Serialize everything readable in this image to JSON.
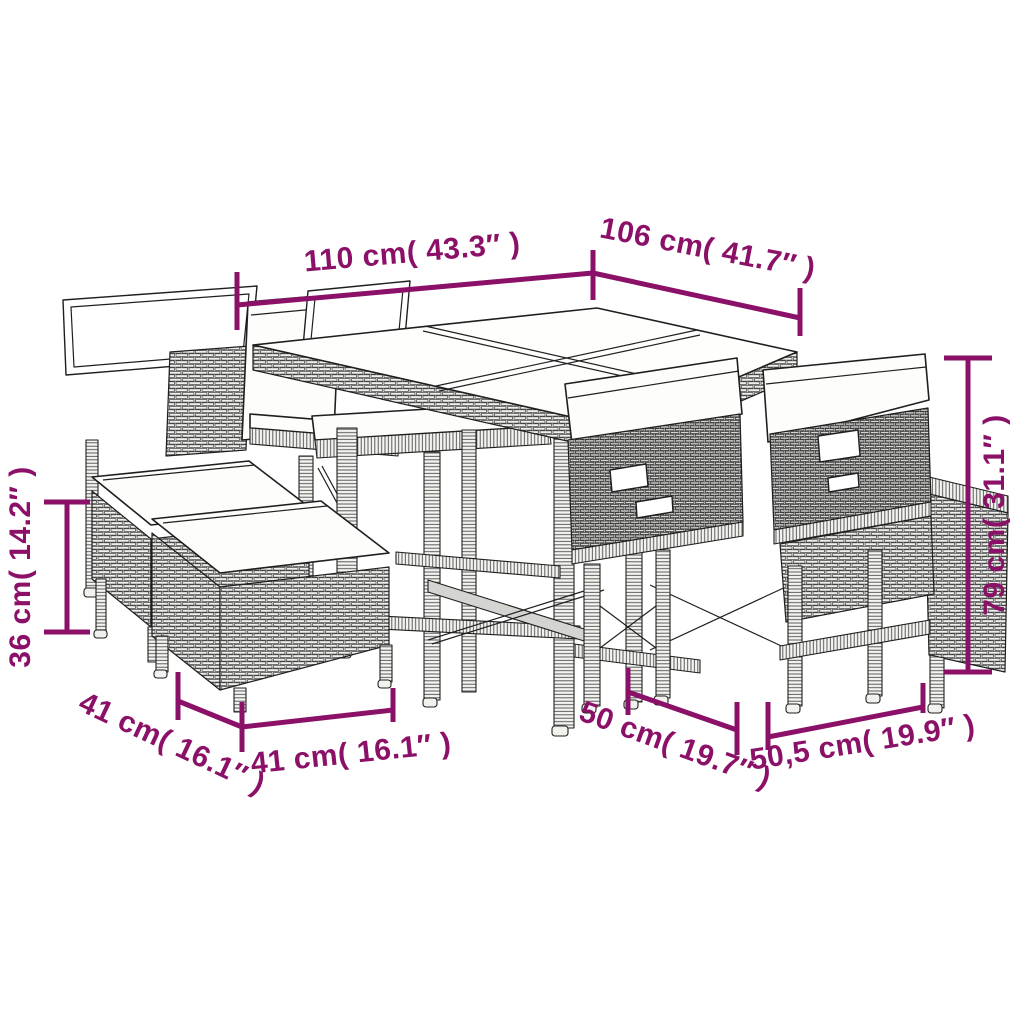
{
  "diagram": {
    "type": "product-dimension-diagram",
    "subject": "poly rattan garden dining set: glass-top table, cushioned chairs, stacking ottomans",
    "background": "#ffffff"
  },
  "colors": {
    "dimension_accent": "#8B1168",
    "line_art": "#1f1f1f",
    "cushion": "#ffffff"
  },
  "annotations": {
    "table_width": {
      "label": "110 cm( 43.3″ )"
    },
    "table_depth": {
      "label": "106 cm( 41.7″ )"
    },
    "chair_height": {
      "label": "79 cm( 31.1″ )"
    },
    "stool_height": {
      "label": "36 cm( 14.2″ )"
    },
    "stool_depth": {
      "label": "41 cm( 16.1″ )"
    },
    "stool_width": {
      "label": "41 cm( 16.1″ )"
    },
    "chair_depth": {
      "label": "50 cm( 19.7″ )"
    },
    "chair_width": {
      "label": "50,5 cm( 19.9″ )"
    }
  }
}
